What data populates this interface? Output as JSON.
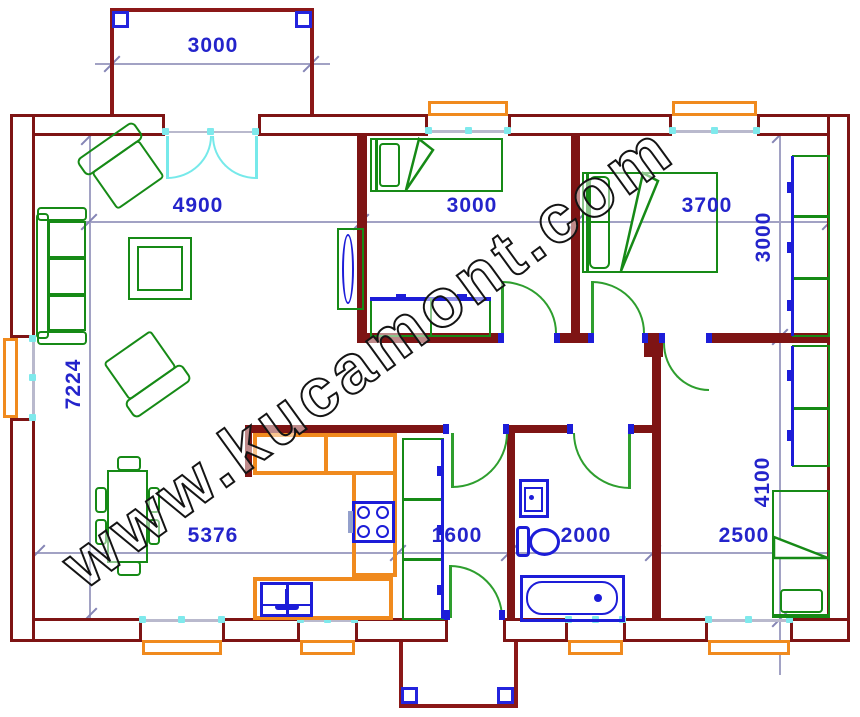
{
  "watermark": {
    "text": "www.kucamont.com"
  },
  "dimensions": {
    "porch_top_width": "3000",
    "living_width": "4900",
    "bedroom1_width": "3000",
    "bedroom2_width": "3700",
    "bedroom2_height": "3000",
    "living_height": "7224",
    "living_kitchen_width": "5376",
    "vestibule_width": "1600",
    "bathroom_width": "2000",
    "bedroom3_width": "2500",
    "bedroom3_height": "4100"
  },
  "colors": {
    "wall": "#7e1414",
    "furniture_green": "#168a16",
    "door_green": "#2e9e2e",
    "entry_door_cyan": "#76e9ea",
    "fixture_blue": "#1d1dd8",
    "counter_orange": "#f08a1e",
    "dimension_text_blue": "#2424cb",
    "dimension_line_gray": "#a2a2c4"
  }
}
